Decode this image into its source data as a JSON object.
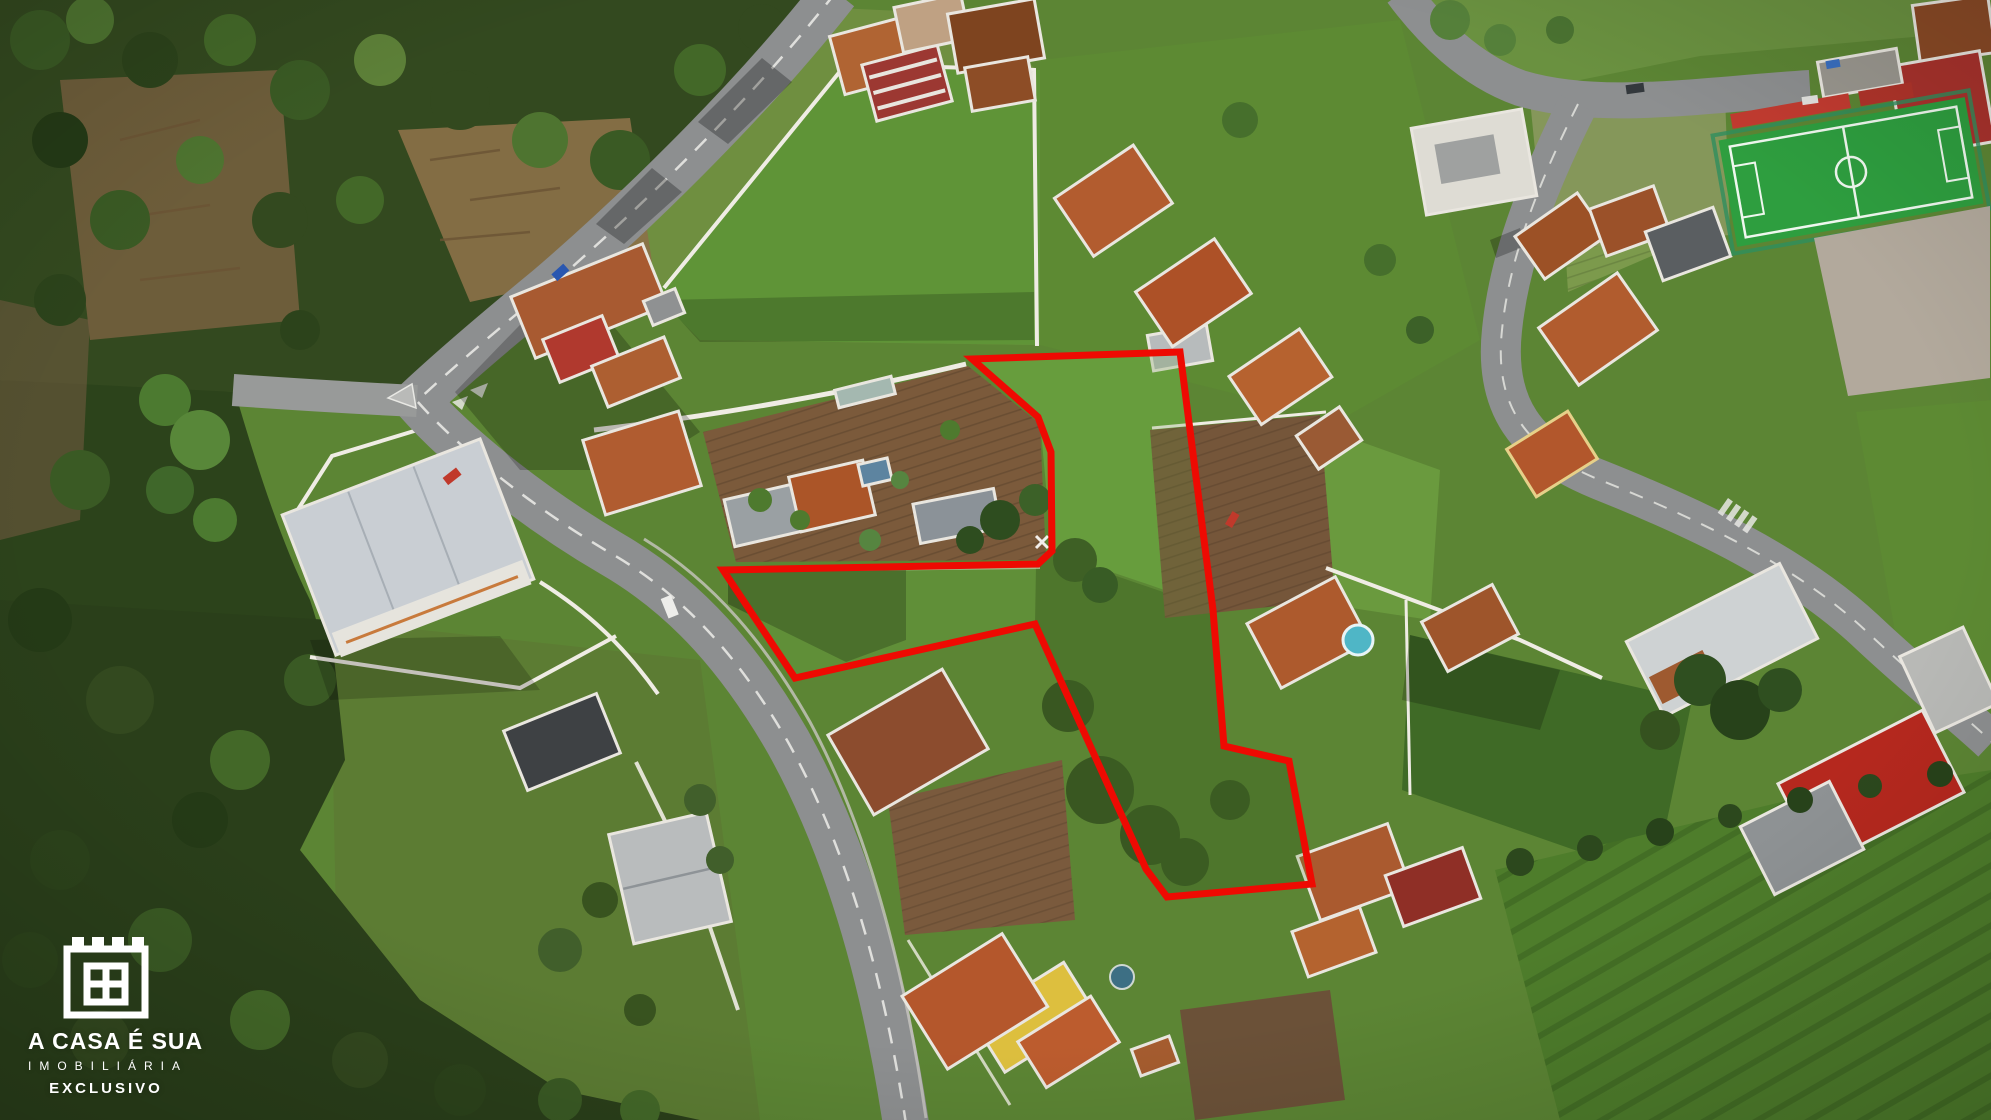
{
  "watermark": {
    "brand": "A CASA É SUA",
    "sector": "IMOBILIÁRIA",
    "tag": "EXCLUSIVO",
    "color": "#ffffff"
  },
  "icons": {
    "watermark_logo": "window-frame-icon"
  },
  "plot_boundary": {
    "color": "#ee0a02",
    "stroke_width": "7",
    "points": "972,359 1180,352 1213,610 1224,746 1289,761 1312,884 1167,897 1146,869 1035,624 795,678 723,570 1038,564 1052,551 1051,452 1038,417"
  }
}
